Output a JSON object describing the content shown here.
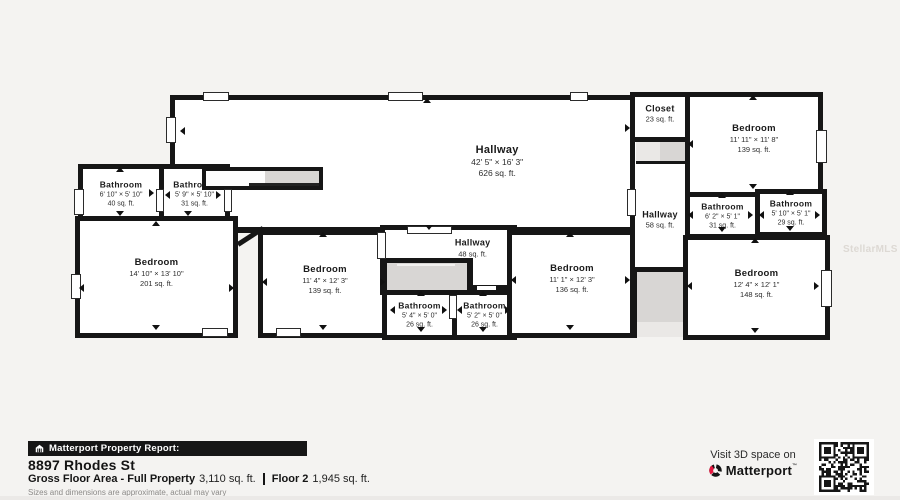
{
  "watermark": "StellarMLS",
  "rooms": {
    "hallway_main": {
      "label": "Hallway",
      "dims": "42' 5\" × 16' 3\"",
      "area": "626 sq. ft."
    },
    "bathroom_40": {
      "label": "Bathroom",
      "dims": "6' 10\" × 5' 10\"",
      "area": "40 sq. ft."
    },
    "bathroom_31a": {
      "label": "Bathroom",
      "dims": "5' 9\" × 5' 10\"",
      "area": "31 sq. ft."
    },
    "bedroom_201": {
      "label": "Bedroom",
      "dims": "14' 10\" × 13' 10\"",
      "area": "201 sq. ft."
    },
    "bedroom_139m": {
      "label": "Bedroom",
      "dims": "11' 4\" × 12' 3\"",
      "area": "139 sq. ft."
    },
    "hallway_48": {
      "label": "Hallway",
      "area": "48 sq. ft."
    },
    "bathroom_26a": {
      "label": "Bathroom",
      "dims": "5' 4\" × 5' 0\"",
      "area": "26 sq. ft."
    },
    "bathroom_26b": {
      "label": "Bathroom",
      "dims": "5' 2\" × 5' 0\"",
      "area": "26 sq. ft."
    },
    "bedroom_136": {
      "label": "Bedroom",
      "dims": "11' 1\" × 12' 3\"",
      "area": "136 sq. ft."
    },
    "closet_23": {
      "label": "Closet",
      "area": "23 sq. ft."
    },
    "hallway_58": {
      "label": "Hallway",
      "area": "58 sq. ft."
    },
    "bedroom_139r": {
      "label": "Bedroom",
      "dims": "11' 11\" × 11' 8\"",
      "area": "139 sq. ft."
    },
    "bathroom_31b": {
      "label": "Bathroom",
      "dims": "6' 2\" × 5' 1\"",
      "area": "31 sq. ft."
    },
    "bathroom_29": {
      "label": "Bathroom",
      "dims": "5' 10\" × 5' 1\"",
      "area": "29 sq. ft."
    },
    "bedroom_148": {
      "label": "Bedroom",
      "dims": "12' 4\" × 12' 1\"",
      "area": "148 sq. ft."
    }
  },
  "footer": {
    "report_badge": "Matterport Property Report:",
    "address": "8897 Rhodes St",
    "gross_label": "Gross Floor Area - Full Property",
    "gross_value": "3,110 sq. ft.",
    "floor_label": "Floor 2",
    "floor_value": "1,945 sq. ft.",
    "disclaimer": "Sizes and dimensions are approximate, actual may vary"
  },
  "cta": {
    "line1": "Visit 3D space on",
    "brand": "Matterport",
    "trademark": "™"
  },
  "colors": {
    "wall": "#161616",
    "background": "#f4f3f1",
    "stairs_gray": "#d8d6d4",
    "badge_bg": "#161616",
    "brand_red": "#e5173f"
  }
}
